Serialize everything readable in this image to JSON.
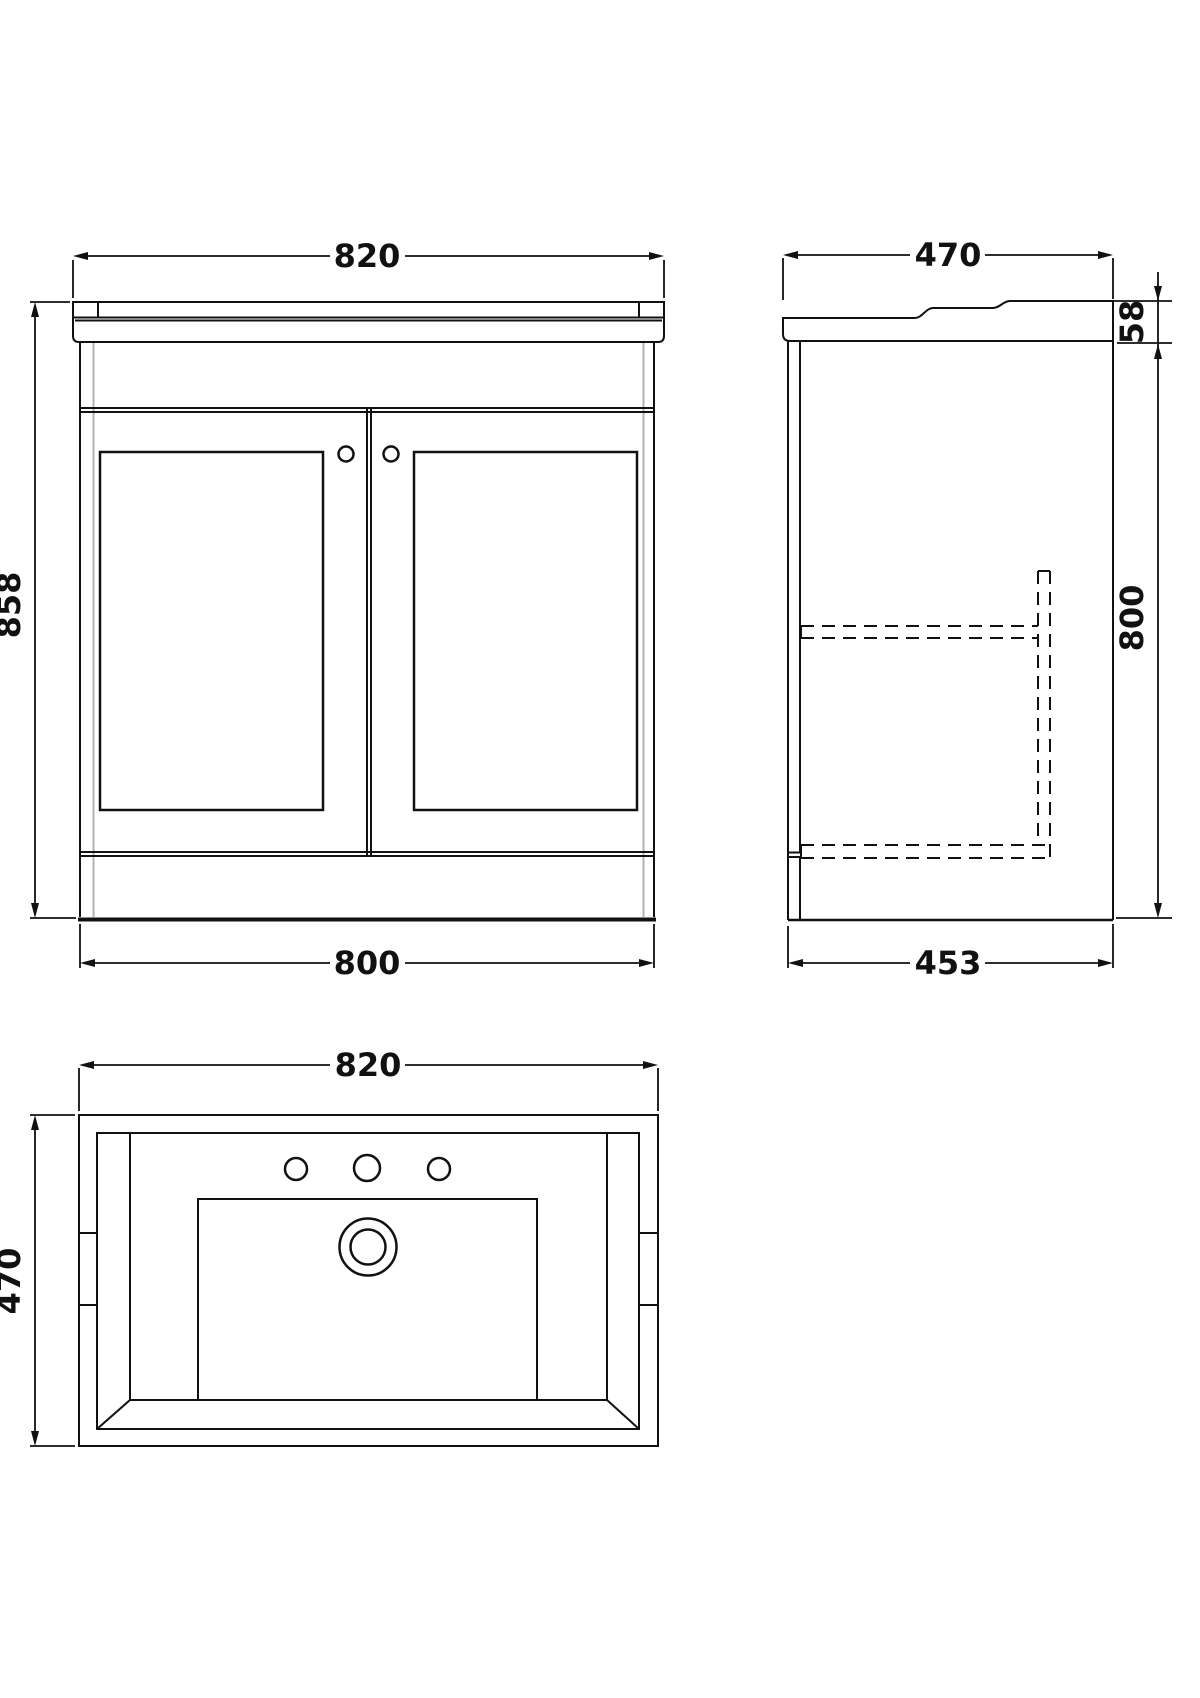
{
  "drawing": {
    "background": "#ffffff",
    "line_color": "#111111",
    "shade_line_color": "#b3b3b3",
    "views": {
      "front": {
        "label": "front-view",
        "dim_width_top": "820",
        "dim_height": "858",
        "dim_width_bottom": "800"
      },
      "side": {
        "label": "side-view",
        "dim_depth_top": "470",
        "dim_counter_thickness": "58",
        "dim_height": "800",
        "dim_depth_bottom": "453"
      },
      "plan": {
        "label": "plan-view",
        "dim_width": "820",
        "dim_depth": "470"
      }
    }
  }
}
